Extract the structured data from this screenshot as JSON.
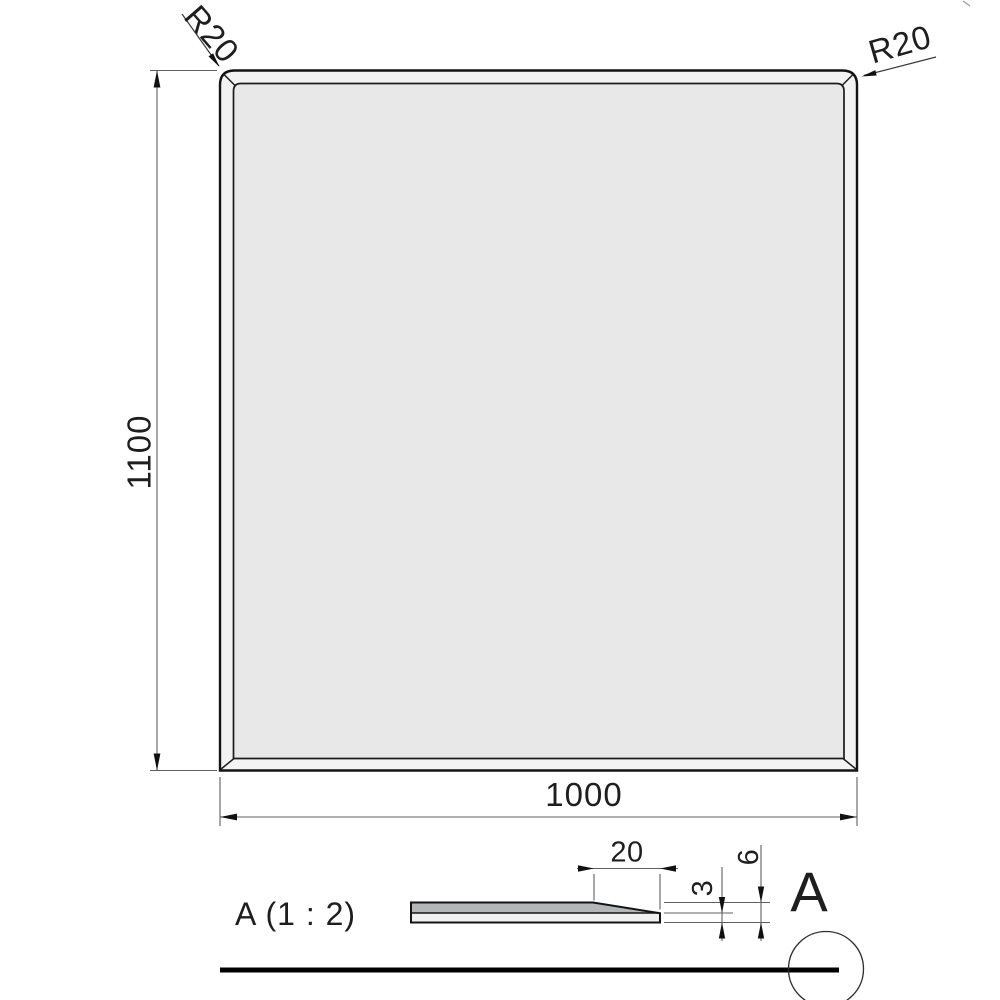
{
  "main_view": {
    "corner_radius_top_left": "R20",
    "corner_radius_top_right": "R20",
    "height": "1100",
    "width": "1000"
  },
  "detail_view": {
    "label": "A (1 : 2)",
    "bevel_width": "20",
    "edge_thickness": "3",
    "panel_thickness": "6"
  },
  "detail_callout": {
    "letter": "A"
  },
  "colors": {
    "panel_fill": "#e8e8e8",
    "bevel_band_fill": "#f3f3f3",
    "section_top_fill": "#b4b7b7",
    "section_bottom_fill": "#f0f0f0",
    "outline": "#141414",
    "dimension_line": "#606060",
    "text": "#1e1e1e"
  }
}
